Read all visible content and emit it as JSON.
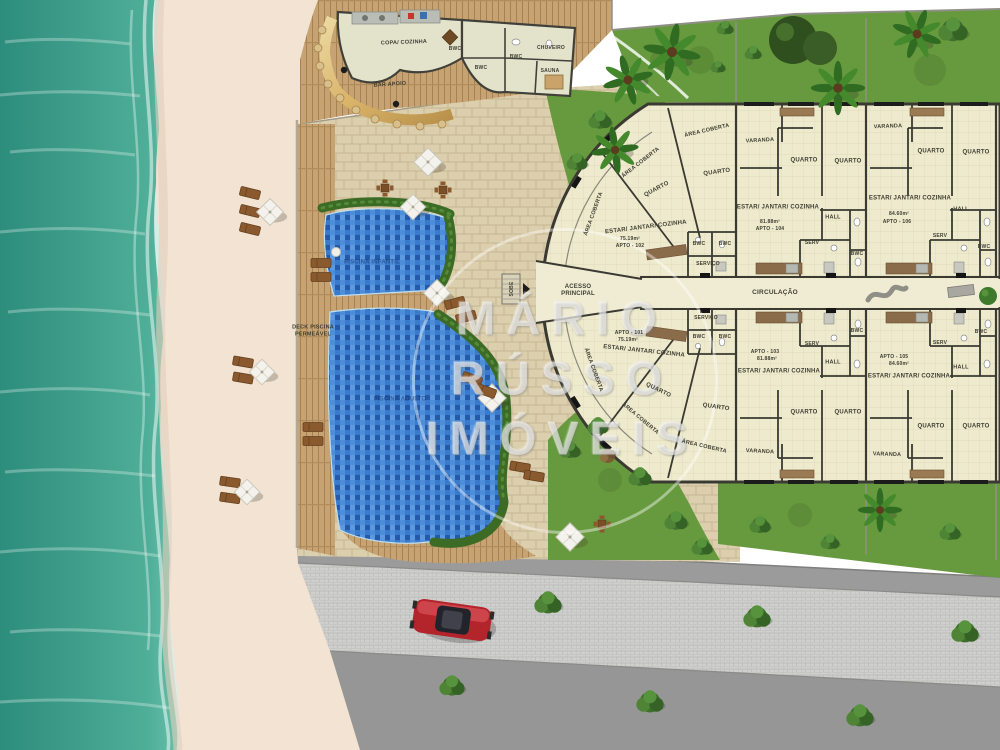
{
  "plan_type": "condominium-site-plan",
  "watermark": {
    "lines": [
      "MÁRIO",
      "RÚSSO",
      "IMÓVEIS"
    ]
  },
  "apartments": [
    {
      "id": "APTO - 101",
      "area": "75.19m²"
    },
    {
      "id": "APTO - 102",
      "area": "75.19m²"
    },
    {
      "id": "APTO - 103",
      "area": "81.88m²"
    },
    {
      "id": "APTO - 104",
      "area": "81.88m²"
    },
    {
      "id": "APTO - 105",
      "area": "84.60m²"
    },
    {
      "id": "APTO - 106",
      "area": "84.60m²"
    }
  ],
  "colors": {
    "ocean_deep": "#2d8d7c",
    "ocean_shore": "#6fc7b2",
    "sand": "#f2e3d2",
    "wood_deck": "#c7a374",
    "pavers": "#dccfae",
    "pool": "#2f6cc0",
    "hedge": "#3c6b25",
    "grass": "#679a3e",
    "floor": "#eeeacd",
    "wall": "#3a3a32",
    "road_asphalt": "#9b9b9b",
    "road_cobble": "#cfcfcd",
    "car_red": "#b3242b",
    "bar_gold": "#d9b469"
  },
  "labels": [
    {
      "text": "COPA/ COZINHA",
      "x": 404,
      "y": 43,
      "rot": -2,
      "size": 5.5
    },
    {
      "text": "BWC",
      "x": 455,
      "y": 49,
      "rot": 0,
      "size": 5
    },
    {
      "text": "BWC",
      "x": 481,
      "y": 68,
      "rot": 0,
      "size": 5
    },
    {
      "text": "BWC",
      "x": 516,
      "y": 57,
      "rot": 0,
      "size": 5
    },
    {
      "text": "CHUVEIRO",
      "x": 551,
      "y": 48,
      "rot": 0,
      "size": 5
    },
    {
      "text": "SAUNA",
      "x": 550,
      "y": 71,
      "rot": 0,
      "size": 5
    },
    {
      "text": "BAR APOIO",
      "x": 390,
      "y": 85,
      "rot": -4,
      "size": 5.5
    },
    {
      "text": "DECK PISCINA\nPERMEÁVEL",
      "x": 313,
      "y": 331,
      "rot": 0,
      "size": 5.5
    },
    {
      "text": "PISCINA INFANTIL",
      "x": 372,
      "y": 263,
      "rot": 0,
      "size": 6,
      "color": "rgba(25,55,115,0.6)"
    },
    {
      "text": "PISCINA ADULTO",
      "x": 400,
      "y": 400,
      "rot": 0,
      "size": 6,
      "color": "rgba(25,55,115,0.6)"
    },
    {
      "text": "SOBE",
      "x": 512,
      "y": 289,
      "rot": -90,
      "size": 5
    },
    {
      "text": "ACESSO\nPRINCIPAL",
      "x": 578,
      "y": 291,
      "rot": 0,
      "size": 6
    },
    {
      "text": "CIRCULAÇÃO",
      "x": 775,
      "y": 293,
      "rot": 0,
      "size": 6.5
    },
    {
      "text": "ÁREA COBERTA",
      "x": 707,
      "y": 131,
      "rot": -13,
      "size": 5.5
    },
    {
      "text": "ÁREA COBERTA",
      "x": 641,
      "y": 163,
      "rot": -38,
      "size": 5.5
    },
    {
      "text": "ÁREA COBERTA",
      "x": 594,
      "y": 214,
      "rot": -70,
      "size": 5.5
    },
    {
      "text": "QUARTO",
      "x": 657,
      "y": 190,
      "rot": -28,
      "size": 6
    },
    {
      "text": "QUARTO",
      "x": 717,
      "y": 173,
      "rot": -8,
      "size": 6
    },
    {
      "text": "ESTAR/ JANTAR/ COZINHA",
      "x": 646,
      "y": 228,
      "rot": -7,
      "size": 6
    },
    {
      "text": "75.19m²",
      "x": 630,
      "y": 239,
      "rot": 0,
      "size": 5
    },
    {
      "text": "APTO - 102",
      "x": 630,
      "y": 246,
      "rot": 0,
      "size": 5
    },
    {
      "text": "BWC",
      "x": 699,
      "y": 244,
      "rot": 0,
      "size": 5
    },
    {
      "text": "BWC",
      "x": 725,
      "y": 244,
      "rot": 0,
      "size": 5
    },
    {
      "text": "SERVIÇO",
      "x": 708,
      "y": 264,
      "rot": 0,
      "size": 5
    },
    {
      "text": "VARANDA",
      "x": 760,
      "y": 141,
      "rot": -3,
      "size": 5.5
    },
    {
      "text": "QUARTO",
      "x": 804,
      "y": 161,
      "rot": 0,
      "size": 6
    },
    {
      "text": "QUARTO",
      "x": 848,
      "y": 162,
      "rot": 0,
      "size": 6
    },
    {
      "text": "ESTAR/ JANTAR/ COZINHA",
      "x": 778,
      "y": 208,
      "rot": 0,
      "size": 6
    },
    {
      "text": "81.88m²",
      "x": 770,
      "y": 222,
      "rot": 0,
      "size": 5
    },
    {
      "text": "APTO - 104",
      "x": 770,
      "y": 229,
      "rot": 0,
      "size": 5
    },
    {
      "text": "HALL",
      "x": 833,
      "y": 218,
      "rot": 0,
      "size": 5.5
    },
    {
      "text": "SERV",
      "x": 812,
      "y": 243,
      "rot": 0,
      "size": 5
    },
    {
      "text": "BWC",
      "x": 857,
      "y": 254,
      "rot": 0,
      "size": 5
    },
    {
      "text": "VARANDA",
      "x": 888,
      "y": 127,
      "rot": -2,
      "size": 5.5
    },
    {
      "text": "QUARTO",
      "x": 931,
      "y": 152,
      "rot": 0,
      "size": 6
    },
    {
      "text": "QUARTO",
      "x": 976,
      "y": 153,
      "rot": 0,
      "size": 6
    },
    {
      "text": "ESTAR/ JANTAR/ COZINHA",
      "x": 910,
      "y": 199,
      "rot": 0,
      "size": 6
    },
    {
      "text": "84.60m²",
      "x": 899,
      "y": 214,
      "rot": 0,
      "size": 5
    },
    {
      "text": "APTO - 106",
      "x": 897,
      "y": 222,
      "rot": 0,
      "size": 5
    },
    {
      "text": "HALL",
      "x": 961,
      "y": 210,
      "rot": 0,
      "size": 5.5
    },
    {
      "text": "SERV",
      "x": 940,
      "y": 236,
      "rot": 0,
      "size": 5
    },
    {
      "text": "BWC",
      "x": 984,
      "y": 247,
      "rot": 0,
      "size": 5
    },
    {
      "text": "SERVIÇO",
      "x": 706,
      "y": 318,
      "rot": 0,
      "size": 5
    },
    {
      "text": "BWC",
      "x": 699,
      "y": 337,
      "rot": 0,
      "size": 5
    },
    {
      "text": "BWC",
      "x": 725,
      "y": 337,
      "rot": 0,
      "size": 5
    },
    {
      "text": "APTO - 101",
      "x": 629,
      "y": 333,
      "rot": 0,
      "size": 5
    },
    {
      "text": "75.19m²",
      "x": 628,
      "y": 340,
      "rot": 0,
      "size": 5
    },
    {
      "text": "ESTAR/ JANTAR/ COZINHA",
      "x": 644,
      "y": 352,
      "rot": 6,
      "size": 6
    },
    {
      "text": "ÁREA COBERTA",
      "x": 593,
      "y": 370,
      "rot": 70,
      "size": 5.5
    },
    {
      "text": "QUARTO",
      "x": 658,
      "y": 391,
      "rot": 26,
      "size": 6
    },
    {
      "text": "ÁREA COBERTA",
      "x": 640,
      "y": 419,
      "rot": 40,
      "size": 5.5
    },
    {
      "text": "QUARTO",
      "x": 716,
      "y": 408,
      "rot": 8,
      "size": 6
    },
    {
      "text": "ÁREA COBERTA",
      "x": 704,
      "y": 447,
      "rot": 13,
      "size": 5.5
    },
    {
      "text": "SERV",
      "x": 812,
      "y": 344,
      "rot": 0,
      "size": 5
    },
    {
      "text": "BWC",
      "x": 857,
      "y": 331,
      "rot": 0,
      "size": 5
    },
    {
      "text": "APTO - 103",
      "x": 765,
      "y": 352,
      "rot": 0,
      "size": 5
    },
    {
      "text": "81.88m²",
      "x": 767,
      "y": 359,
      "rot": 0,
      "size": 5
    },
    {
      "text": "HALL",
      "x": 833,
      "y": 363,
      "rot": 0,
      "size": 5.5
    },
    {
      "text": "ESTAR/ JANTAR/ COZINHA",
      "x": 779,
      "y": 372,
      "rot": 0,
      "size": 6
    },
    {
      "text": "QUARTO",
      "x": 804,
      "y": 413,
      "rot": 0,
      "size": 6
    },
    {
      "text": "QUARTO",
      "x": 848,
      "y": 413,
      "rot": 0,
      "size": 6
    },
    {
      "text": "VARANDA",
      "x": 760,
      "y": 452,
      "rot": 3,
      "size": 5.5
    },
    {
      "text": "SERV",
      "x": 940,
      "y": 343,
      "rot": 0,
      "size": 5
    },
    {
      "text": "BWC",
      "x": 981,
      "y": 332,
      "rot": 0,
      "size": 5
    },
    {
      "text": "APTO - 105",
      "x": 894,
      "y": 357,
      "rot": 0,
      "size": 5
    },
    {
      "text": "84.60m²",
      "x": 899,
      "y": 364,
      "rot": 0,
      "size": 5
    },
    {
      "text": "ESTAR/ JANTAR/ COZINHA",
      "x": 909,
      "y": 377,
      "rot": 0,
      "size": 6
    },
    {
      "text": "HALL",
      "x": 961,
      "y": 368,
      "rot": 0,
      "size": 5.5
    },
    {
      "text": "QUARTO",
      "x": 931,
      "y": 427,
      "rot": 0,
      "size": 6
    },
    {
      "text": "QUARTO",
      "x": 976,
      "y": 427,
      "rot": 0,
      "size": 6
    },
    {
      "text": "VARANDA",
      "x": 887,
      "y": 455,
      "rot": 2,
      "size": 5.5
    }
  ]
}
